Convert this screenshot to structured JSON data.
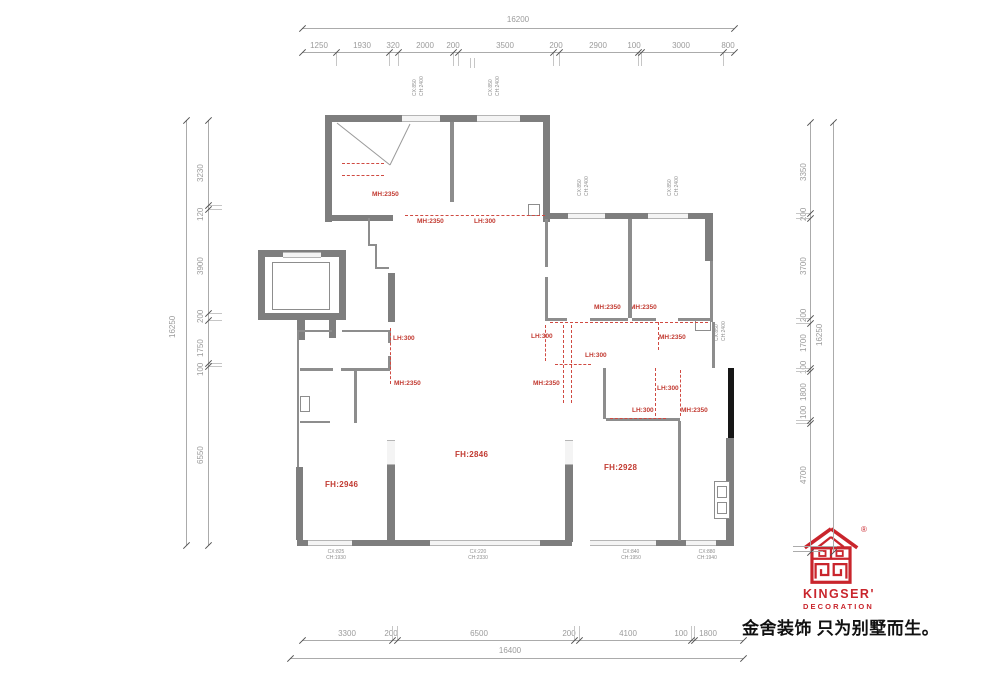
{
  "title": "Residential floor plan with height annotations",
  "dimensions": {
    "top": {
      "total": "16200",
      "segments": [
        "1250",
        "1930",
        "320",
        "2000",
        "200",
        "3500",
        "200",
        "2900",
        "100",
        "3000",
        "800"
      ]
    },
    "bottom": {
      "total": "16400",
      "segments": [
        "3300",
        "200",
        "6500",
        "200",
        "4100",
        "100",
        "1800"
      ]
    },
    "left": {
      "total": "16250",
      "segments": [
        "3230",
        "120",
        "3900",
        "200",
        "1750",
        "100",
        "6550"
      ]
    },
    "right": {
      "total": "16250",
      "segments": [
        "3350",
        "200",
        "3700",
        "200",
        "1700",
        "100",
        "1800",
        "100",
        "4700"
      ]
    }
  },
  "height_annotations": [
    "MH:2350",
    "MH:2350",
    "LH:300",
    "LH:300",
    "MH:2350",
    "LH:300",
    "MH:2350",
    "MH:2350",
    "MH:2350",
    "MH:2350",
    "LH:300",
    "LH:300",
    "LH:300",
    "MH:2350"
  ],
  "floor_height_labels": {
    "left": "FH:2946",
    "center": "FH:2846",
    "right": "FH:2928"
  },
  "window_labels_bottom": [
    {
      "cx": "CX:825",
      "ch": "CH:1930"
    },
    {
      "cx": "CX:220",
      "ch": "CH:2330"
    },
    {
      "cx": "CX:840",
      "ch": "CH:1950"
    },
    {
      "cx": "CX:880",
      "ch": "CH:1940"
    }
  ],
  "window_labels_small": [
    {
      "cx": "CX:850",
      "ch": "CH:2400"
    },
    {
      "cx": "CX:850",
      "ch": "CH:2400"
    },
    {
      "cx": "CX:850",
      "ch": "CH:2400"
    },
    {
      "cx": "CX:850",
      "ch": "CH:2400"
    },
    {
      "cx": "CX:850",
      "ch": "CH:2400"
    }
  ],
  "logo": {
    "brand": "KINGSER'",
    "subtitle": "DECORATION",
    "registered": "®",
    "slogan": "金舍装饰 只为别墅而生。"
  },
  "colors": {
    "wall_gray": "#7e7e7e",
    "annotation_red": "#c23b32",
    "logo_red": "#c9252c",
    "dim_gray": "#9b9b9b"
  }
}
